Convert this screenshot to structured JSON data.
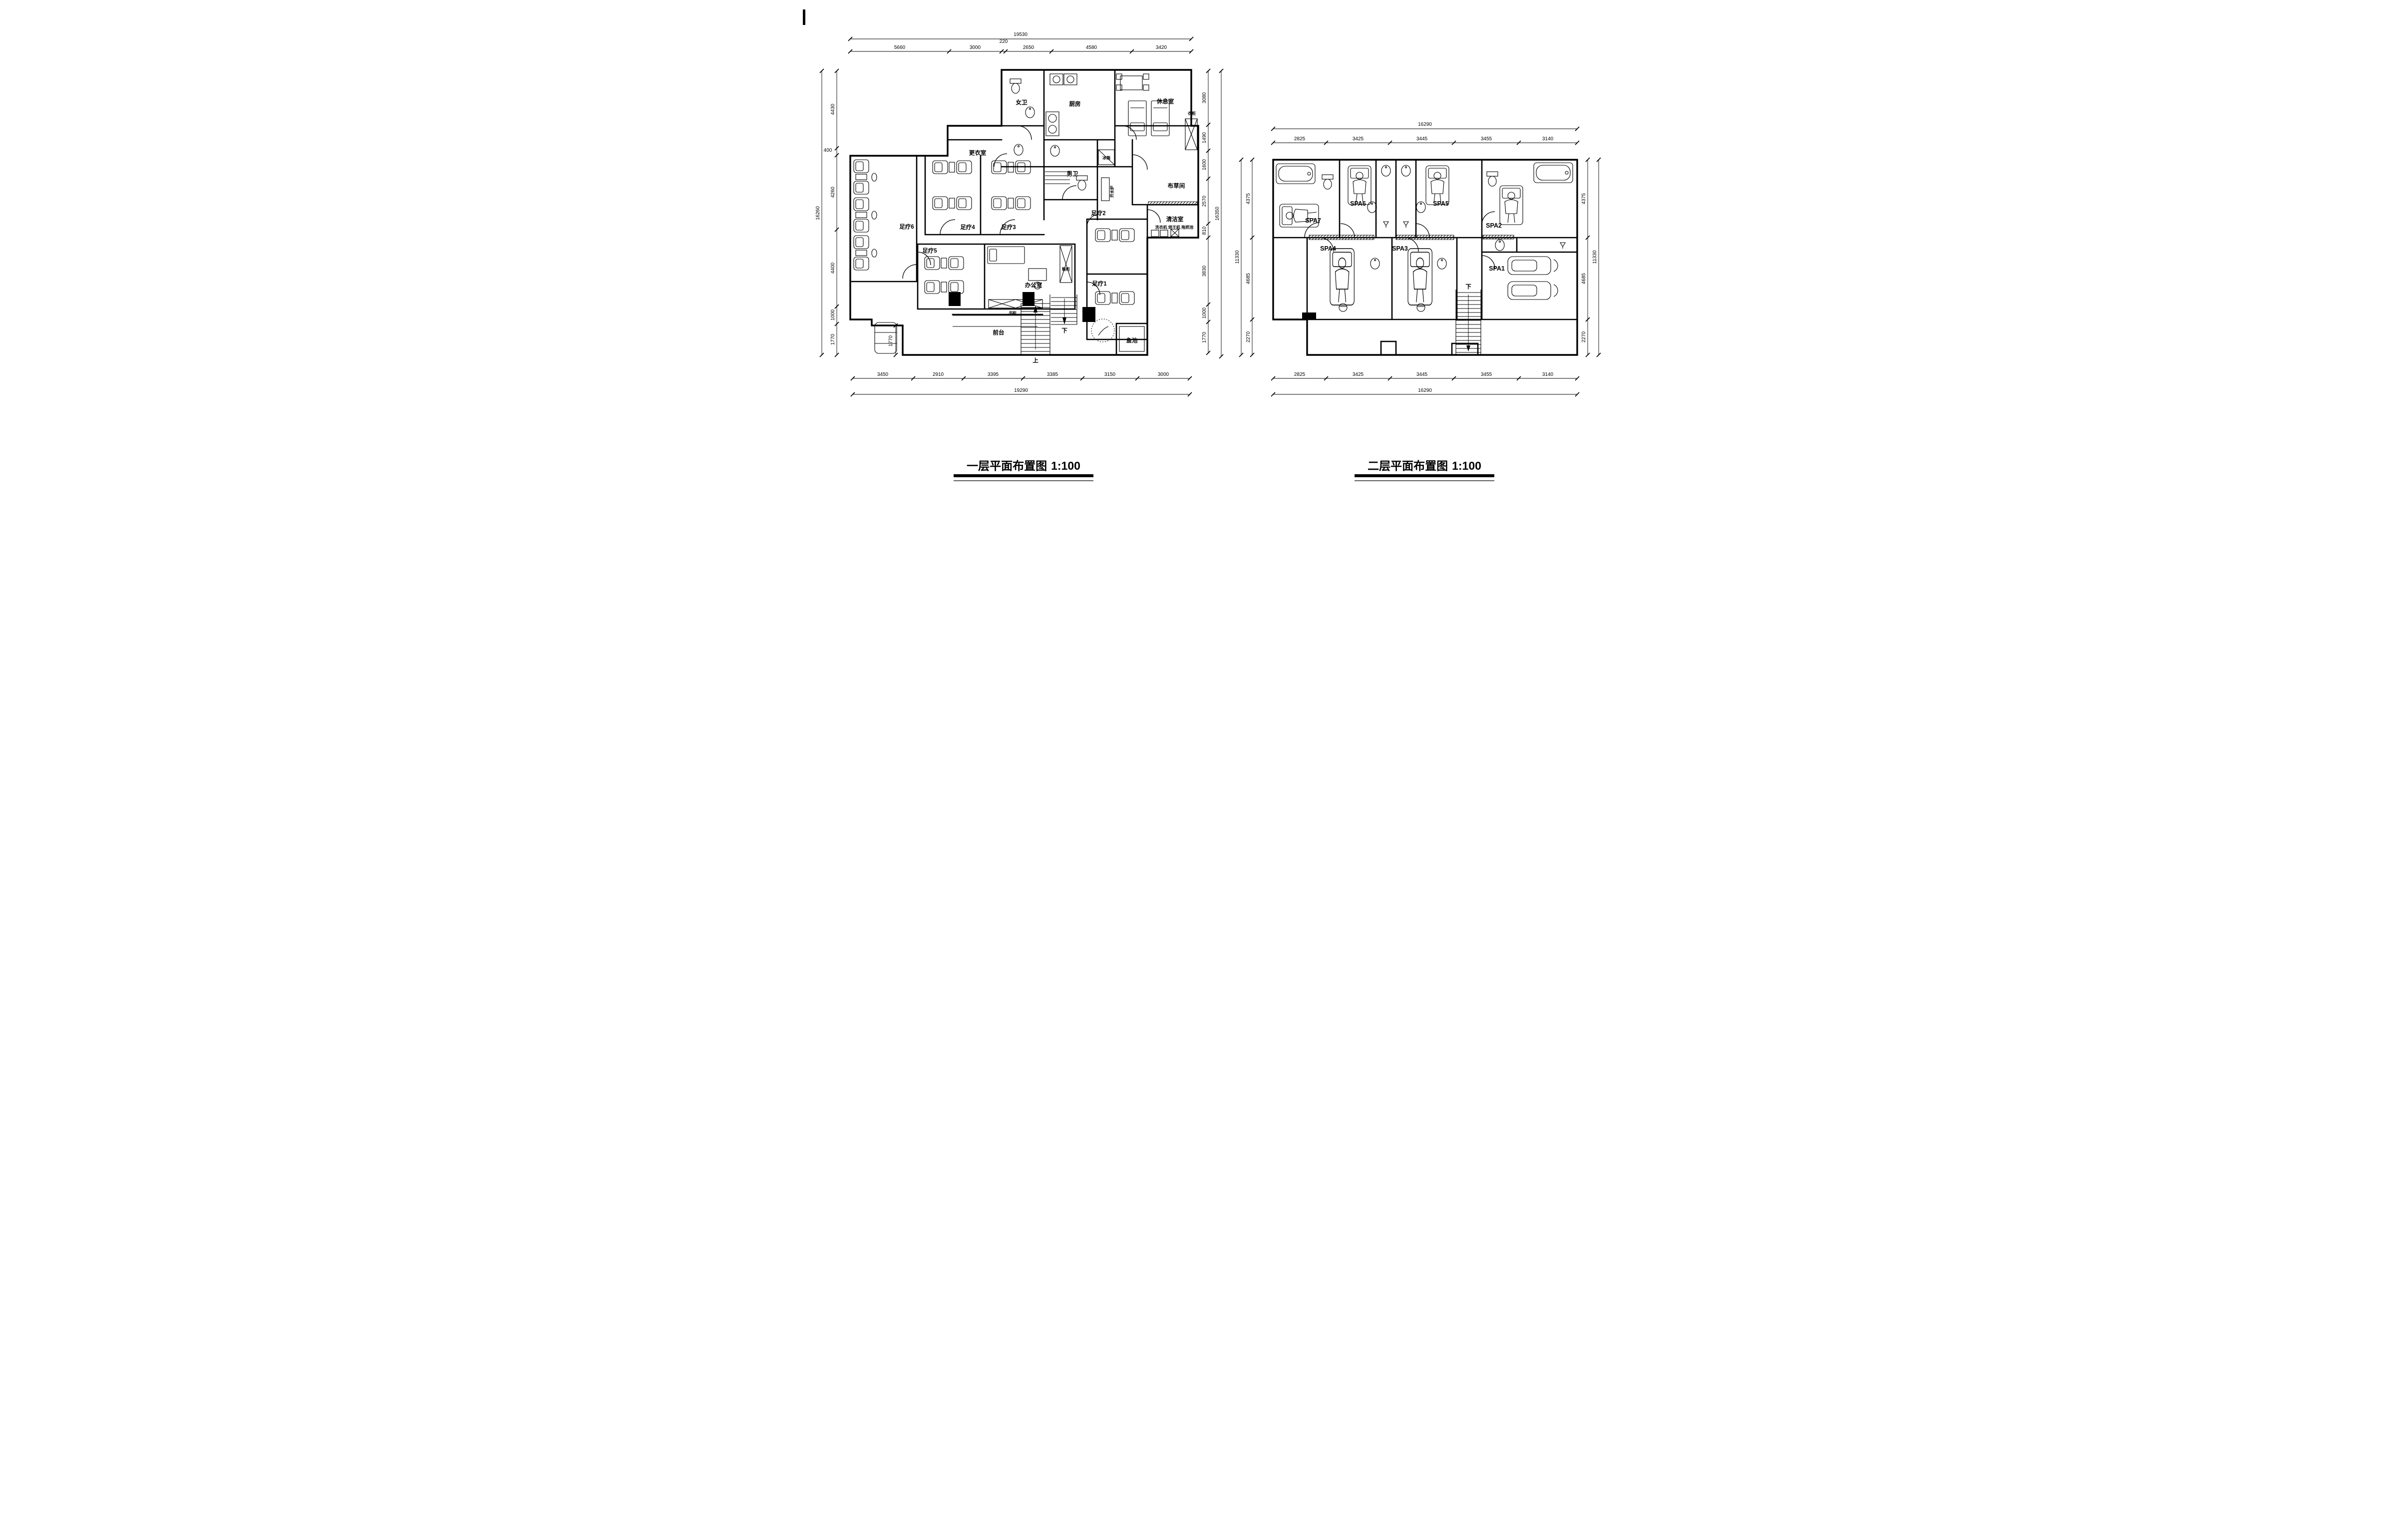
{
  "page": {
    "background": "#ffffff",
    "line_color": "#000000"
  },
  "plan1": {
    "title": "一层平面布置图",
    "scale_label": "1:100",
    "rooms": {
      "nv_wei": "女卫",
      "chufang": "厨房",
      "xiuxishi": "休息室",
      "yigui": "衣柜",
      "bingxiang": "冰箱",
      "nan_wei": "男卫",
      "gengyishi": "更衣室",
      "kaishuilu": "开水炉",
      "bucaojian": "布草间",
      "qingjieshi": "清洁室",
      "qingjieshi_items": "洗衣机 烘干机 拖把池",
      "zuliao1": "足疗1",
      "zuliao2": "足疗2",
      "zuliao3": "足疗3",
      "zuliao4": "足疗4",
      "zuliao5": "足疗5",
      "zuliao6": "足疗6",
      "bangongshi": "办公室",
      "xiegui": "鞋柜",
      "shugui": "书柜",
      "qiantai": "前台",
      "yuchi": "鱼池",
      "stair_up": "上",
      "stair_down": "下"
    },
    "dims": {
      "top": {
        "total": "19530",
        "segments": [
          "5660",
          "3000",
          "220",
          "2650",
          "4580",
          "3420"
        ]
      },
      "bottom": {
        "total": "19290",
        "segments": [
          "3450",
          "2910",
          "3395",
          "3385",
          "3150",
          "3000"
        ]
      },
      "left": {
        "total": "16260",
        "segments": [
          "4430",
          "400",
          "4260",
          "4400",
          "1000",
          "1770"
        ]
      },
      "right": {
        "total": "16350",
        "segments": [
          "3080",
          "1490",
          "1600",
          "2570",
          "810",
          "3830",
          "1000",
          "1770"
        ]
      },
      "interior": "1770"
    }
  },
  "plan2": {
    "title": "二层平面布置图",
    "scale_label": "1:100",
    "rooms": {
      "spa1": "SPA1",
      "spa2": "SPA2",
      "spa3": "SPA3",
      "spa4": "SPA4",
      "spa5": "SPA5",
      "spa6": "SPA6",
      "spa7": "SPA7",
      "stair_down": "下"
    },
    "dims": {
      "top": {
        "total": "16290",
        "segments": [
          "2825",
          "3425",
          "3445",
          "3455",
          "3140"
        ]
      },
      "bottom": {
        "total": "16290",
        "segments": [
          "2825",
          "3425",
          "3445",
          "3455",
          "3140"
        ]
      },
      "left": {
        "total": "11330",
        "segments": [
          "4375",
          "4685",
          "2270"
        ]
      },
      "right": {
        "total": "11330",
        "segments": [
          "4375",
          "4685",
          "2270"
        ]
      }
    }
  }
}
